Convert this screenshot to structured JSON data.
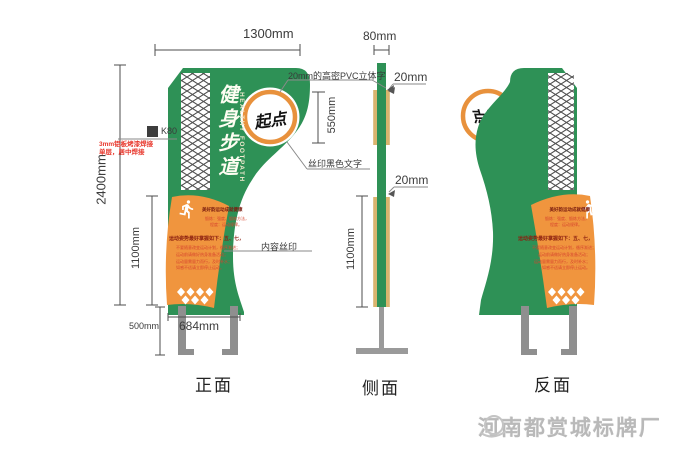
{
  "views": {
    "front": {
      "label": "正面"
    },
    "side": {
      "label": "侧面"
    },
    "back": {
      "label": "反面"
    }
  },
  "sign": {
    "title_cn": "健身步道",
    "title_en": "HEALTHY FOOTPATH",
    "start_marker": "起点",
    "panel": {
      "title": "美好韵运动成就健康",
      "sub_lines": [
        "锻炼：强度、锻炼方法，",
        "程度：运动规律。"
      ],
      "notice": "运动姿势最好掌握如下：五、七，",
      "body_lines": [
        "不要随意改变运动计划，循序渐进；",
        "运动前请做好热身准备活动；",
        "运动量需量力而行，及时补水；",
        "如感不适请立即停止运动。"
      ]
    }
  },
  "dimensions": {
    "front_width": "1300mm",
    "total_height": "2400mm",
    "panel_height": "1100mm",
    "leg_height": "500mm",
    "leg_span": "684mm",
    "side_thickness": "80mm",
    "letter_depth": "20mm",
    "letter_zone_height": "550mm",
    "panel_depth": "20mm",
    "side_panel_height": "1100mm"
  },
  "annotations": {
    "pvc_letters": "20mm的高密PVC立体字",
    "silk_black_text": "丝印黑色文字",
    "content_silk": "内容丝印",
    "color_code": "K80",
    "material_note_line1": "3mm铝板烤漆焊接",
    "material_note_line2": "单层，居中焊接"
  },
  "footer": {
    "brand": "河南都赏城标牌厂",
    "phone_icon": "phone-swoosh-icon"
  },
  "colors": {
    "sign_green": "#2e9156",
    "panel_orange": "#f0953e",
    "ring_orange": "#e8913c",
    "side_strip_tan": "#d9b46e",
    "structure_gray": "#8f8f8f",
    "dimension_line": "#4d4d4d",
    "note_red": "#e8372c",
    "panel_title_maroon": "#7a1c10"
  }
}
